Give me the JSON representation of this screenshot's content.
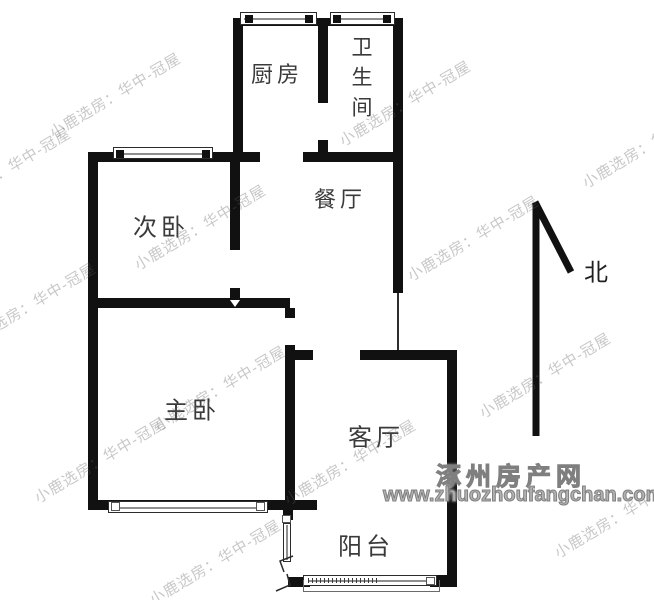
{
  "plan": {
    "rooms": [
      {
        "id": "kitchen",
        "label": "厨房"
      },
      {
        "id": "bathroom",
        "label": "卫生间"
      },
      {
        "id": "second-bedroom",
        "label": "次卧"
      },
      {
        "id": "dining-room",
        "label": "餐厅"
      },
      {
        "id": "master-bedroom",
        "label": "主卧"
      },
      {
        "id": "living-room",
        "label": "客厅"
      },
      {
        "id": "balcony",
        "label": "阳台"
      }
    ],
    "compass": {
      "label": "北"
    }
  },
  "watermarks": {
    "diagonal_text": "小鹿选房：华中-冠屋",
    "site_name": "涿州房产网",
    "site_url": "www.zhuozhoufangchan.com"
  },
  "colors": {
    "wall": "#111111",
    "label_text": "#3a3a3a",
    "watermark_gray": "#b3b3b3"
  }
}
